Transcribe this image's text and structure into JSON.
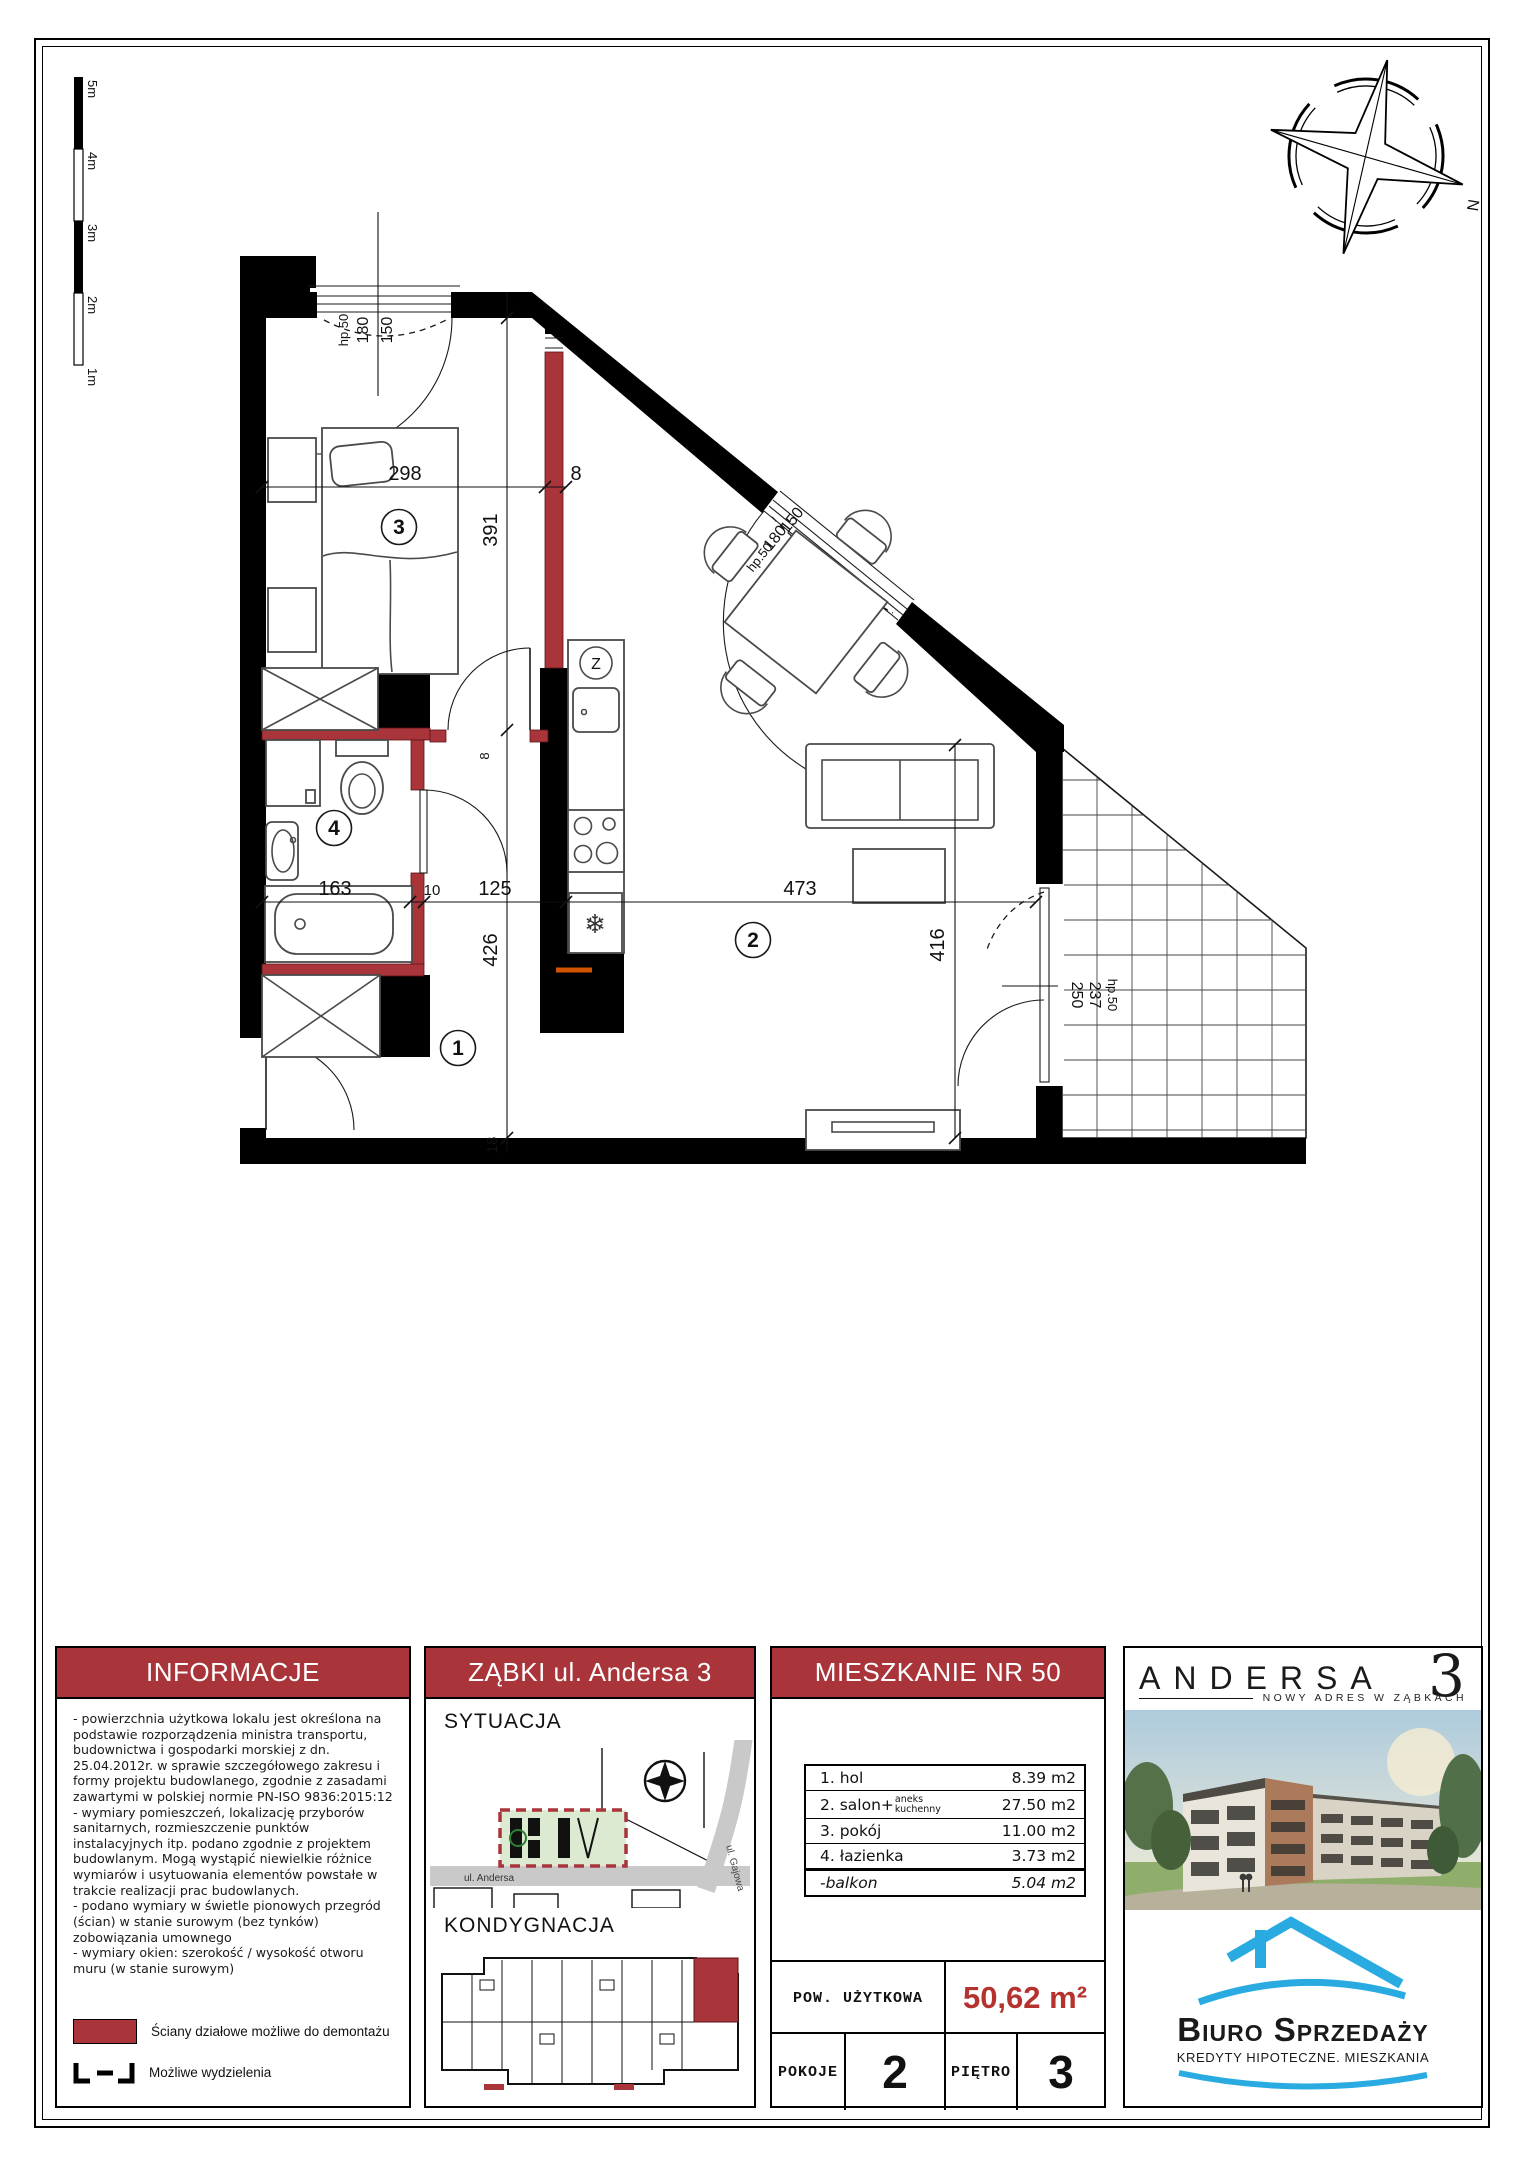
{
  "plan": {
    "rooms": {
      "hol": "1",
      "salon": "2",
      "pokoj": "3",
      "lazienka": "4"
    },
    "dims": {
      "bedroom_width": "298",
      "wall_a": "8",
      "bedroom_depth": "391",
      "bath_width": "163",
      "wall_b": "10",
      "hall_width": "125",
      "salon_width": "473",
      "hall_depth": "426",
      "wall_c": "18",
      "salon_depth": "416",
      "door_w": "8"
    },
    "window_bedroom": {
      "w": "150",
      "h": "180",
      "sill": "hp.50"
    },
    "window_salon": {
      "w": "150",
      "h": "180",
      "sill": "hp.50"
    },
    "window_balcony": {
      "w": "250",
      "h": "237",
      "sill": "hp.50"
    },
    "kitchen": {
      "sink_symbol": "Z",
      "fridge_symbol": "❄"
    },
    "scale_bar": [
      "5m",
      "4m",
      "3m",
      "2m",
      "1m"
    ],
    "compass": {
      "north": "N"
    }
  },
  "panels": {
    "informacje": {
      "title": "INFORMACJE",
      "paragraphs": [
        "- powierzchnia użytkowa lokalu jest określona na podstawie rozporządzenia ministra transportu, budownictwa i gospodarki morskiej z dn. 25.04.2012r. w sprawie szczegółowego zakresu i formy projektu budowlanego, zgodnie z zasadami zawartymi w polskiej normie PN-ISO 9836:2015:12",
        "- wymiary pomieszczeń, lokalizację przyborów sanitarnych, rozmieszczenie punktów instalacyjnych itp. podano zgodnie z projektem budowlanym. Mogą wystąpić niewielkie różnice wymiarów i usytuowania elementów powstałe w trakcie realizacji prac budowlanych.",
        "- podano wymiary w świetle pionowych przegród (ścian) w stanie surowym (bez tynków)",
        "zobowiązania umownego",
        "- wymiary okien: szerokość / wysokość otworu muru (w stanie surowym)"
      ],
      "legend": [
        {
          "label": "Ściany działowe możliwe do demontażu"
        },
        {
          "label": "Możliwe wydzielenia"
        }
      ]
    },
    "lokalizacja": {
      "title": "ZĄBKI ul. Andersa 3",
      "sytuacja": "SYTUACJA",
      "kondygnacja": "KONDYGNACJA",
      "street_andersa": "ul. Andersa",
      "street_gajowa": "ul. Gajowa"
    },
    "mieszkanie": {
      "title": "MIESZKANIE NR 50",
      "rows": [
        {
          "name": "1. hol",
          "area": "8.39 m2"
        },
        {
          "name": "2. salon+",
          "name_small_1": "aneks",
          "name_small_2": "kuchenny",
          "area": "27.50 m2"
        },
        {
          "name": "3. pokój",
          "area": "11.00 m2"
        },
        {
          "name": "4. łazienka",
          "area": "3.73 m2"
        },
        {
          "name": "-balkon",
          "area": "5.04 m2"
        }
      ],
      "pow_label": "POW. UŻYTKOWA",
      "pow_value": "50,62 m²",
      "pokoje_label": "POKOJE",
      "pokoje_value": "2",
      "pietro_label": "PIĘTRO",
      "pietro_value": "3"
    },
    "andersa": {
      "brand": "ANDERSA",
      "brand_no": "3",
      "tagline": "NOWY ADRES W ZĄBKACH",
      "biuro": "Biuro Sprzedaży",
      "biuro_sub": "KREDYTY HIPOTECZNE. MIESZKANIA"
    }
  },
  "colors": {
    "accent_red": "#A93439",
    "value_red": "#B5332E",
    "biuro_blue": "#29ABE2"
  }
}
